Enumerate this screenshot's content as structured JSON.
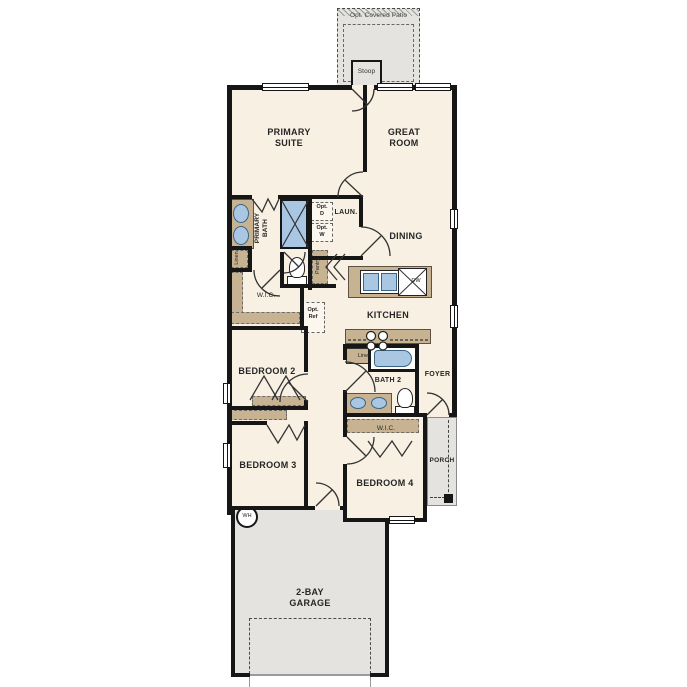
{
  "plan_title": "single-story floor plan",
  "labels": {
    "opt_covered_patio": "Opt. Covered Patio",
    "stoop": "Stoop",
    "primary_suite": "PRIMARY\nSUITE",
    "great_room": "GREAT\nROOM",
    "primary_bath": "PRIMARY\nBATH",
    "laundry": "LAUN.",
    "opt_dryer": "Opt.\nD",
    "opt_washer": "Opt.\nW",
    "dining": "DINING",
    "linen_primary": "Linen",
    "pantry": "Pantry",
    "wic_primary": "W.I.C.",
    "opt_ref": "Opt.\nRef",
    "kitchen": "KITCHEN",
    "dishwasher": "DW",
    "bedroom2": "BEDROOM 2",
    "linen_bath2": "Linen",
    "bath2": "BATH 2",
    "foyer": "FOYER",
    "bedroom3": "BEDROOM 3",
    "wic_bed4": "W.I.C.",
    "bedroom4": "BEDROOM 4",
    "porch": "PORCH",
    "water_heater": "WH",
    "garage": "2-BAY\nGARAGE"
  },
  "colors": {
    "floor": "#f7f0e3",
    "wall": "#161616",
    "cabinet": "#c7b391",
    "exterior": "#e5e3e0",
    "fixture": "#a9c7e3",
    "line": "#333333"
  }
}
